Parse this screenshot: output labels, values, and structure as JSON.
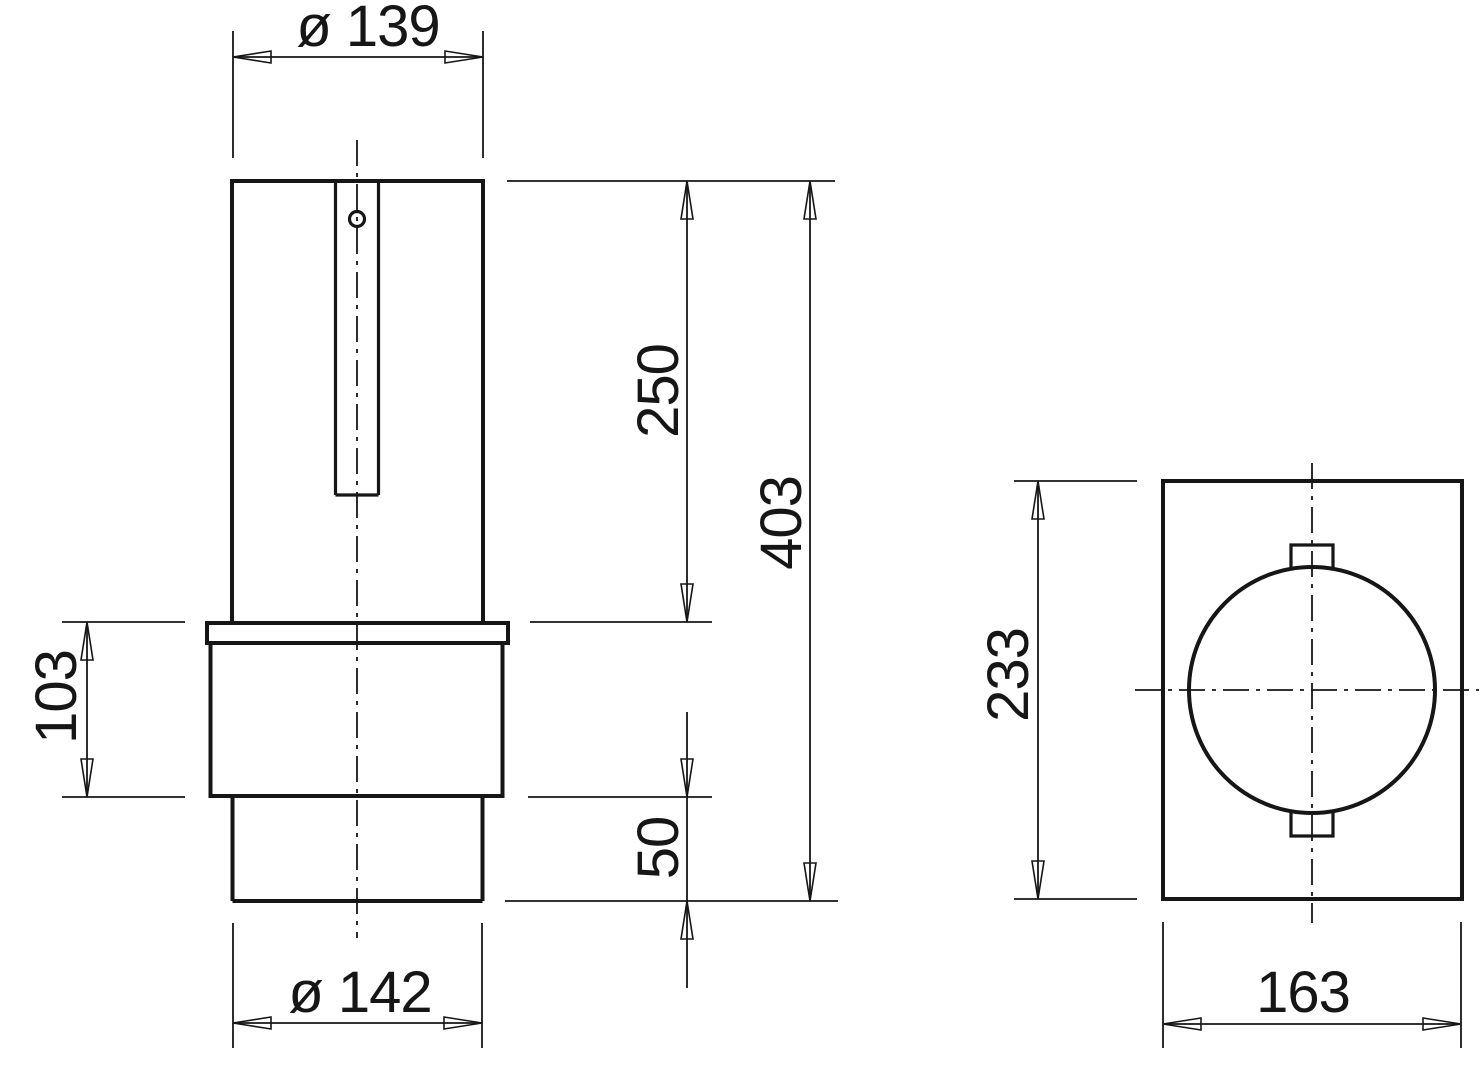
{
  "title": "Two-view technical drawing of a flanged cylindrical component",
  "colors": {
    "background": "#ffffff",
    "line": "#161616"
  },
  "dims": {
    "dia_top": {
      "label": "ø 139",
      "value": 139
    },
    "upper_length": {
      "label": "250",
      "value": 250
    },
    "total_length": {
      "label": "403",
      "value": 403
    },
    "flange_length": {
      "label": "103",
      "value": 103
    },
    "lower_length": {
      "label": "50",
      "value": 50
    },
    "dia_bottom": {
      "label": "ø 142",
      "value": 142
    },
    "plate_height": {
      "label": "233",
      "value": 233
    },
    "plate_width": {
      "label": "163",
      "value": 163
    }
  }
}
